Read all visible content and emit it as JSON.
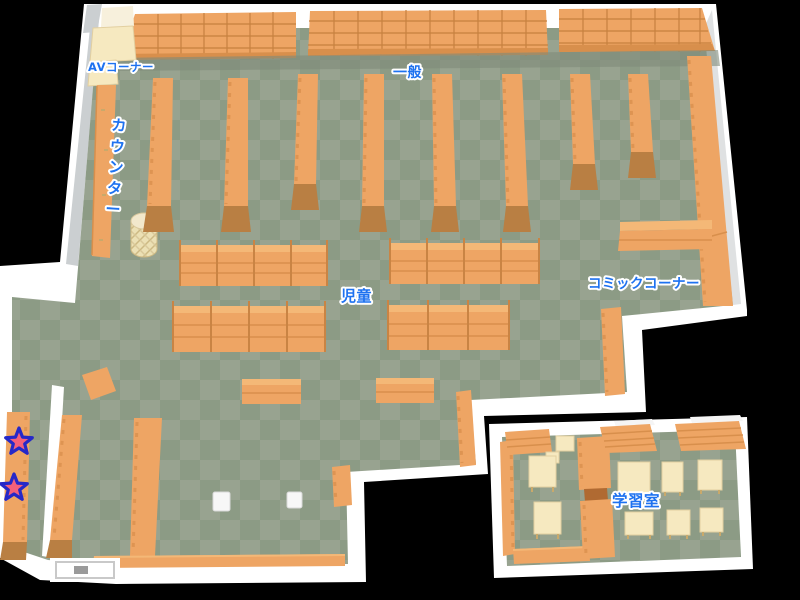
{
  "map_name": "library-floor-map",
  "areas": {
    "av_corner": {
      "label": "AVコーナー"
    },
    "general": {
      "label": "一般"
    },
    "counter": {
      "label": "カウンター"
    },
    "children": {
      "label": "児童"
    },
    "comic_corner": {
      "label": "コミックコーナー"
    },
    "study_room": {
      "label": "学習室"
    }
  },
  "markers": {
    "stars": {
      "count": 2,
      "fill": "#f4607a",
      "outline": "#2628c8"
    }
  },
  "colors": {
    "background": "#000000",
    "wall": "#ffffff",
    "wall_shade": "#cbcfd1",
    "floor_light": "#98a390",
    "floor_dark": "#8c9b85",
    "shelf": "#eea564",
    "shelf_dark": "#d88f4c",
    "shelf_cap": "#b97f43",
    "desk_cream": "#f6e9c0",
    "label_blue": "#1e72f0",
    "label_halo": "#ffffff",
    "star_fill": "#f4607a",
    "star_outline": "#2628c8"
  }
}
